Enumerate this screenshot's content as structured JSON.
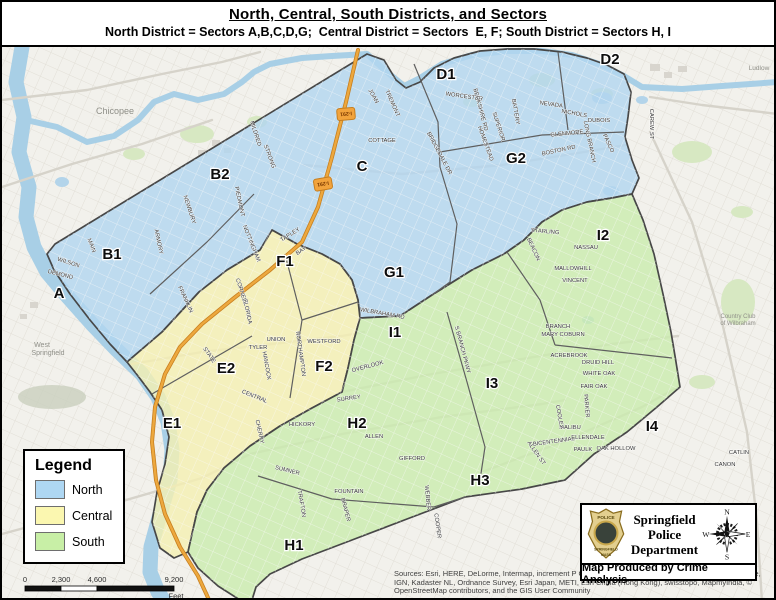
{
  "title": {
    "main": "North, Central, South Districts, and Sectors",
    "subtitle": "North District = Sectors A,B,C,D,G;  Central District = Sectors  E, F; South District = Sectors H, I"
  },
  "legend": {
    "title": "Legend",
    "items": [
      {
        "label": "North",
        "color": "#aed7f3"
      },
      {
        "label": "Central",
        "color": "#fbf7b0"
      },
      {
        "label": "South",
        "color": "#c8efa6"
      }
    ]
  },
  "credits": {
    "department": [
      "Springfield",
      "Police",
      "Department"
    ],
    "produced_by": "Map Produced by Crime Analysis",
    "compass": {
      "n": "N",
      "e": "E",
      "s": "S",
      "w": "W"
    },
    "badge": {
      "top": "POLICE",
      "middle": "SPRINGFIELD",
      "bottom": "MASS"
    }
  },
  "sources": "Sources: Esri, HERE, DeLorme, Intermap, increment P Corp., GEBCO, USGS, FAO, NPS, NRCAN, GeoBase, IGN, Kadaster NL, Ordnance Survey, Esri Japan, METI, Esri China (Hong Kong), swisstopo, MapmyIndia, © OpenStreetMap contributors, and the GIS User Community",
  "scale_bar": {
    "ticks": [
      {
        "label": "0",
        "x": 23
      },
      {
        "label": "2,300",
        "x": 59
      },
      {
        "label": "4,600",
        "x": 95
      },
      {
        "label": "9,200",
        "x": 172
      }
    ],
    "unit": "Feet",
    "segments": [
      {
        "x1": 23,
        "x2": 59,
        "fill": "#111111"
      },
      {
        "x1": 59,
        "x2": 95,
        "fill": "#ffffff"
      },
      {
        "x1": 95,
        "x2": 172,
        "fill": "#111111"
      }
    ],
    "y": 584,
    "h": 5
  },
  "map": {
    "colors": {
      "base": "#f2f1ec",
      "grid": "#e2dfd7",
      "river": "#a8cfe6",
      "pond": "#b3d4ea",
      "park": "#d7e8c2",
      "ridge": "#c9cfbe",
      "building": "#d8d5ce",
      "boundary": "#474747",
      "divider": "#5f5f5f",
      "road_gray": "#d6d3ca",
      "road_orange": "#eda83e",
      "north_fill": "#b2d6ef",
      "central_fill": "#f4efb2",
      "south_fill": "#cbecae",
      "street_label": "#333333",
      "basemap_label": "#8f8f88",
      "shield_fill": "#f2a33c",
      "shield_edge": "#c77f1f",
      "shield_text": "#7a3800"
    },
    "districts": {
      "north": {
        "name": "North",
        "points": "365,52 382,58 394,78 404,86 418,80 432,66 452,56 478,49 505,47 532,47 560,50 585,56 605,63 622,72 629,90 626,115 623,135 630,158 637,176 630,192 610,196 585,200 560,208 540,220 522,238 502,252 470,268 430,293 398,314 358,316 356,298 350,278 338,262 320,252 295,242 270,228 258,248 225,268 197,290 160,330 125,360 108,342 88,318 68,292 52,268 45,252 53,242"
      },
      "central": {
        "name": "Central",
        "points": "125,360 160,330 197,290 225,268 258,248 270,228 295,242 320,252 338,262 350,278 356,298 358,316 352,338 346,366 340,390 310,406 278,424 248,444 222,466 205,488 195,510 190,532 186,550 172,556 158,546 150,520 155,490 163,462 167,435 160,408 148,390 136,374"
      },
      "south": {
        "name": "South",
        "points": "358,316 398,314 430,293 470,268 502,252 522,238 540,220 560,208 585,200 610,196 630,192 641,218 652,252 661,292 669,330 674,360 678,385 655,405 625,430 592,452 563,478 520,487 463,495 405,517 350,538 300,557 268,572 254,585 250,598 246,600 238,598 216,584 196,566 186,550 190,532 195,510 205,488 222,466 248,444 278,424 310,406 340,390 346,366 352,338"
      }
    },
    "rivers": [
      {
        "name": "connecticut-river",
        "w": 15,
        "points": "20,45 14,80 22,115 17,150 27,185 24,215 32,245 45,270 66,295 90,322 115,348 140,372 156,395 166,420 170,448 168,478 158,512 149,545 148,570 156,590 163,600"
      },
      {
        "name": "chicopee-river",
        "w": 6,
        "points": "24,118 55,125 85,140 112,134 136,118 152,100 172,92 196,98 222,92 240,80 252,70 268,62 300,56 330,54 365,52 385,70 402,84 418,76 440,62 470,53 505,49 540,49 570,53 600,63 622,74 640,85 680,87 720,84 776,80"
      }
    ],
    "ponds": [
      {
        "x": 600,
        "y": 96,
        "rx": 10,
        "ry": 6
      },
      {
        "x": 609,
        "y": 189,
        "rx": 8,
        "ry": 5
      },
      {
        "x": 640,
        "y": 98,
        "rx": 6,
        "ry": 4
      },
      {
        "x": 586,
        "y": 318,
        "rx": 6,
        "ry": 4
      },
      {
        "x": 60,
        "y": 180,
        "rx": 7,
        "ry": 5
      }
    ],
    "parks": [
      {
        "x": 195,
        "y": 132,
        "rx": 17,
        "ry": 9
      },
      {
        "x": 132,
        "y": 152,
        "rx": 11,
        "ry": 6
      },
      {
        "x": 540,
        "y": 78,
        "rx": 13,
        "ry": 7
      },
      {
        "x": 690,
        "y": 150,
        "rx": 20,
        "ry": 11
      },
      {
        "x": 600,
        "y": 92,
        "rx": 11,
        "ry": 6
      },
      {
        "x": 736,
        "y": 300,
        "rx": 17,
        "ry": 23
      },
      {
        "x": 688,
        "y": 556,
        "rx": 22,
        "ry": 12
      },
      {
        "x": 470,
        "y": 100,
        "rx": 9,
        "ry": 5
      },
      {
        "x": 255,
        "y": 120,
        "rx": 10,
        "ry": 6
      },
      {
        "x": 700,
        "y": 380,
        "rx": 13,
        "ry": 7
      },
      {
        "x": 740,
        "y": 210,
        "rx": 11,
        "ry": 6
      },
      {
        "x": 620,
        "y": 560,
        "rx": 13,
        "ry": 7
      }
    ],
    "ridges": [
      {
        "x": 50,
        "y": 395,
        "rx": 34,
        "ry": 12
      }
    ],
    "buildings": [
      {
        "x": 648,
        "y": 62,
        "w": 10,
        "h": 7
      },
      {
        "x": 662,
        "y": 70,
        "w": 8,
        "h": 6
      },
      {
        "x": 676,
        "y": 64,
        "w": 9,
        "h": 6
      },
      {
        "x": 210,
        "y": 138,
        "w": 8,
        "h": 6
      },
      {
        "x": 222,
        "y": 146,
        "w": 7,
        "h": 5
      },
      {
        "x": 196,
        "y": 148,
        "w": 9,
        "h": 6
      },
      {
        "x": 28,
        "y": 300,
        "w": 8,
        "h": 6
      },
      {
        "x": 18,
        "y": 312,
        "w": 7,
        "h": 5
      }
    ],
    "gray_roads": [
      {
        "points": "130,362 200,350 270,342 340,334 362,330"
      },
      {
        "points": "340,390 430,372 520,357 610,342 676,334"
      },
      {
        "points": "302,163 400,172 500,163 570,152 624,143"
      },
      {
        "points": "0,532 100,505 200,476 248,452 340,432 440,415 540,402 563,398"
      },
      {
        "points": "648,130 690,220 720,320 745,430 755,520 760,600"
      },
      {
        "points": "0,98 85,88 160,72 220,60 258,50"
      },
      {
        "points": "0,185 70,162 140,142 210,118"
      },
      {
        "points": "648,95 700,103 776,112"
      },
      {
        "points": "480,470 560,440 640,405 676,385"
      }
    ],
    "orange_roads": [
      {
        "points": "356,48 344,100 330,155 316,205 300,240 268,268 232,296 200,322 178,345 163,372 153,405 150,440 154,478 163,512 178,545 196,574 208,600"
      }
    ],
    "dividers": [
      {
        "points": "148,292 205,240 252,192"
      },
      {
        "points": "412,62 436,120 438,165"
      },
      {
        "points": "438,150 540,133 622,130"
      },
      {
        "points": "556,50 566,128"
      },
      {
        "points": "438,165 455,222 448,280 430,293"
      },
      {
        "points": "283,252 300,318 288,396"
      },
      {
        "points": "300,318 356,300"
      },
      {
        "points": "150,392 250,334"
      },
      {
        "points": "505,250 538,298 553,343"
      },
      {
        "points": "553,343 670,356"
      },
      {
        "points": "445,310 465,380 483,445 478,478"
      },
      {
        "points": "256,474 330,497 432,505 463,495"
      }
    ],
    "sector_labels": [
      {
        "id": "A",
        "x": 57,
        "y": 291
      },
      {
        "id": "B1",
        "x": 110,
        "y": 252
      },
      {
        "id": "B2",
        "x": 218,
        "y": 172
      },
      {
        "id": "C",
        "x": 360,
        "y": 164
      },
      {
        "id": "D1",
        "x": 444,
        "y": 72
      },
      {
        "id": "D2",
        "x": 608,
        "y": 57
      },
      {
        "id": "E1",
        "x": 170,
        "y": 421
      },
      {
        "id": "E2",
        "x": 224,
        "y": 366
      },
      {
        "id": "F1",
        "x": 283,
        "y": 259
      },
      {
        "id": "F2",
        "x": 322,
        "y": 364
      },
      {
        "id": "G1",
        "x": 392,
        "y": 270
      },
      {
        "id": "G2",
        "x": 514,
        "y": 156
      },
      {
        "id": "H1",
        "x": 292,
        "y": 543
      },
      {
        "id": "H2",
        "x": 355,
        "y": 421
      },
      {
        "id": "H3",
        "x": 478,
        "y": 478
      },
      {
        "id": "I1",
        "x": 393,
        "y": 330
      },
      {
        "id": "I2",
        "x": 601,
        "y": 233
      },
      {
        "id": "I3",
        "x": 490,
        "y": 381
      },
      {
        "id": "I4",
        "x": 650,
        "y": 424
      }
    ],
    "city_labels": [
      {
        "t": "Chicopee",
        "x": 113,
        "y": 112,
        "s": 9
      },
      {
        "t": "West",
        "x": 40,
        "y": 345,
        "s": 7
      },
      {
        "t": "Springfield",
        "x": 46,
        "y": 353,
        "s": 7
      },
      {
        "t": "Ludlow",
        "x": 757,
        "y": 68,
        "s": 6.5
      },
      {
        "t": "Country Club",
        "x": 736,
        "y": 316,
        "s": 6
      },
      {
        "t": "of Wilbraham",
        "x": 736,
        "y": 323,
        "s": 6
      }
    ],
    "highway_shields": [
      {
        "t": "I-291",
        "x": 344,
        "y": 112,
        "r": 85
      },
      {
        "t": "I-291",
        "x": 321,
        "y": 182,
        "r": 80
      }
    ],
    "street_labels": [
      {
        "t": "WORCESTER",
        "x": 462,
        "y": 96,
        "r": 8
      },
      {
        "t": "CAREW ST",
        "x": 648,
        "y": 122,
        "r": 90
      },
      {
        "t": "COTTAGE",
        "x": 380,
        "y": 140,
        "r": 0
      },
      {
        "t": "BOSTON RD",
        "x": 557,
        "y": 150,
        "r": -12
      },
      {
        "t": "BRIDGEDALE DR",
        "x": 436,
        "y": 152,
        "r": 62
      },
      {
        "t": "PIEDMONT",
        "x": 236,
        "y": 200,
        "r": 78
      },
      {
        "t": "NEWBURY",
        "x": 186,
        "y": 208,
        "r": 72
      },
      {
        "t": "NOTTINGHAM",
        "x": 248,
        "y": 242,
        "r": 68
      },
      {
        "t": "ARMORY",
        "x": 155,
        "y": 240,
        "r": 78
      },
      {
        "t": "MAIN",
        "x": 88,
        "y": 244,
        "r": 68
      },
      {
        "t": "WILSON",
        "x": 66,
        "y": 262,
        "r": 18
      },
      {
        "t": "DEMOND",
        "x": 58,
        "y": 274,
        "r": 14
      },
      {
        "t": "BERKSHIRE RD",
        "x": 477,
        "y": 108,
        "r": 75
      },
      {
        "t": "BATTERY",
        "x": 512,
        "y": 110,
        "r": 80
      },
      {
        "t": "NEVADA",
        "x": 549,
        "y": 104,
        "r": 8
      },
      {
        "t": "NICHOLS",
        "x": 572,
        "y": 113,
        "r": 10
      },
      {
        "t": "GLENMORE",
        "x": 565,
        "y": 133,
        "r": -6
      },
      {
        "t": "LONG BRANCH",
        "x": 586,
        "y": 140,
        "r": 78
      },
      {
        "t": "TREMONT",
        "x": 389,
        "y": 102,
        "r": 66
      },
      {
        "t": "JOAN",
        "x": 370,
        "y": 95,
        "r": 60
      },
      {
        "t": "SUPERIOR",
        "x": 495,
        "y": 125,
        "r": 72
      },
      {
        "t": "HOMESTEAD",
        "x": 482,
        "y": 142,
        "r": 70
      },
      {
        "t": "STRONG",
        "x": 266,
        "y": 155,
        "r": 70
      },
      {
        "t": "MILDRED",
        "x": 252,
        "y": 132,
        "r": 72
      },
      {
        "t": "DUBOIS",
        "x": 597,
        "y": 120,
        "r": 0
      },
      {
        "t": "PASCO",
        "x": 605,
        "y": 142,
        "r": 65
      },
      {
        "t": "TAPLEY",
        "x": 289,
        "y": 234,
        "r": -32
      },
      {
        "t": "BAY",
        "x": 300,
        "y": 250,
        "r": -35
      },
      {
        "t": "CORNELL",
        "x": 238,
        "y": 290,
        "r": 72
      },
      {
        "t": "FLORIDA",
        "x": 244,
        "y": 310,
        "r": 78
      },
      {
        "t": "WESTFORD",
        "x": 322,
        "y": 341,
        "r": 0
      },
      {
        "t": "NORTHAMPTON",
        "x": 297,
        "y": 352,
        "r": 82
      },
      {
        "t": "UNION",
        "x": 274,
        "y": 339,
        "r": 0
      },
      {
        "t": "TYLER",
        "x": 256,
        "y": 347,
        "r": 0
      },
      {
        "t": "HANCOCK",
        "x": 263,
        "y": 364,
        "r": 80
      },
      {
        "t": "STATE",
        "x": 206,
        "y": 354,
        "r": 55
      },
      {
        "t": "CENTRAL",
        "x": 252,
        "y": 396,
        "r": 22
      },
      {
        "t": "HICKORY",
        "x": 300,
        "y": 424,
        "r": 0
      },
      {
        "t": "CHERRY",
        "x": 256,
        "y": 430,
        "r": 78
      },
      {
        "t": "FRANKLIN",
        "x": 182,
        "y": 298,
        "r": 65
      },
      {
        "t": "WILBRAHAM RD",
        "x": 380,
        "y": 313,
        "r": 10
      },
      {
        "t": "S BRANCH PKWY",
        "x": 459,
        "y": 348,
        "r": 75
      },
      {
        "t": "OVERLOOK",
        "x": 366,
        "y": 366,
        "r": -15
      },
      {
        "t": "SURREY",
        "x": 347,
        "y": 398,
        "r": -8
      },
      {
        "t": "ALLEN",
        "x": 372,
        "y": 436,
        "r": 0
      },
      {
        "t": "GIFFORD",
        "x": 410,
        "y": 458,
        "r": 0
      },
      {
        "t": "SUMNER",
        "x": 285,
        "y": 470,
        "r": 14
      },
      {
        "t": "FOUNTAIN",
        "x": 347,
        "y": 491,
        "r": 0
      },
      {
        "t": "TRAFTON",
        "x": 298,
        "y": 502,
        "r": 80
      },
      {
        "t": "DRAPER",
        "x": 342,
        "y": 508,
        "r": 75
      },
      {
        "t": "COOPER",
        "x": 434,
        "y": 524,
        "r": 82
      },
      {
        "t": "WEBBER",
        "x": 424,
        "y": 496,
        "r": 85
      },
      {
        "t": "BICENTENNIAL",
        "x": 552,
        "y": 441,
        "r": -8
      },
      {
        "t": "ELLENDALE",
        "x": 586,
        "y": 437,
        "r": 0
      },
      {
        "t": "PAULK",
        "x": 581,
        "y": 449,
        "r": 0
      },
      {
        "t": "OAK HOLLOW",
        "x": 614,
        "y": 448,
        "r": 0
      },
      {
        "t": "MALIBU",
        "x": 568,
        "y": 427,
        "r": 0
      },
      {
        "t": "NASSAU",
        "x": 584,
        "y": 247,
        "r": 0
      },
      {
        "t": "MALLOWHILL",
        "x": 571,
        "y": 268,
        "r": 0
      },
      {
        "t": "VINCENT",
        "x": 573,
        "y": 280,
        "r": 0
      },
      {
        "t": "PARKER",
        "x": 583,
        "y": 404,
        "r": 85
      },
      {
        "t": "FAIR OAK",
        "x": 592,
        "y": 386,
        "r": 0
      },
      {
        "t": "WHITE OAK",
        "x": 597,
        "y": 373,
        "r": 0
      },
      {
        "t": "DRUID HILL",
        "x": 596,
        "y": 362,
        "r": 0
      },
      {
        "t": "ACREBROOK",
        "x": 567,
        "y": 355,
        "r": 0
      },
      {
        "t": "MARY COBURN",
        "x": 561,
        "y": 334,
        "r": 0
      },
      {
        "t": "BRANCH",
        "x": 556,
        "y": 326,
        "r": 0
      },
      {
        "t": "COOLEY",
        "x": 556,
        "y": 415,
        "r": 80
      },
      {
        "t": "STARLING",
        "x": 543,
        "y": 231,
        "r": 5
      },
      {
        "t": "BEACON",
        "x": 530,
        "y": 248,
        "r": 65
      },
      {
        "t": "ALLEN ST",
        "x": 533,
        "y": 452,
        "r": 55
      },
      {
        "t": "CATLIN",
        "x": 737,
        "y": 452,
        "r": 0
      },
      {
        "t": "CANON",
        "x": 723,
        "y": 464,
        "r": 0
      }
    ]
  }
}
